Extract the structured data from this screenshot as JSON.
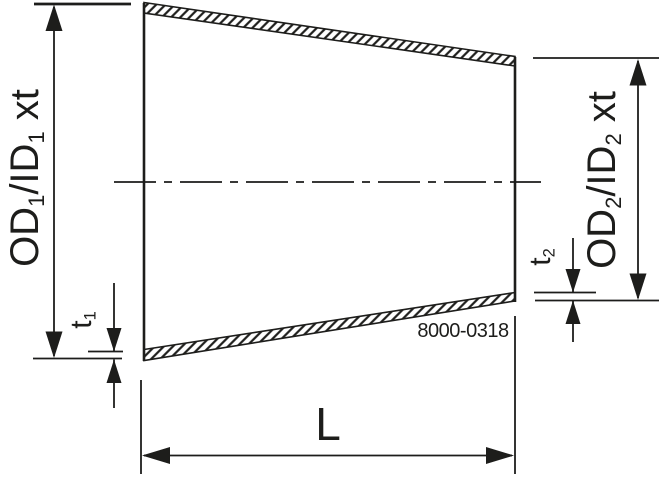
{
  "colors": {
    "background": "#ffffff",
    "line": "#1d1d1b"
  },
  "drawing": {
    "figure": "concentric-reducer-dimension-drawing",
    "labels": {
      "od1": {
        "pre": "OD",
        "sub1": "1",
        "mid": "/ID",
        "sub2": "1",
        "post": " xt"
      },
      "od2": {
        "pre": "OD",
        "sub1": "2",
        "mid": "/ID",
        "sub2": "2",
        "post": " xt"
      },
      "t1": {
        "pre": "t",
        "sub": "1"
      },
      "t2": {
        "pre": "t",
        "sub": "2"
      },
      "length": "L",
      "drawing_number": "8000-0318"
    }
  }
}
